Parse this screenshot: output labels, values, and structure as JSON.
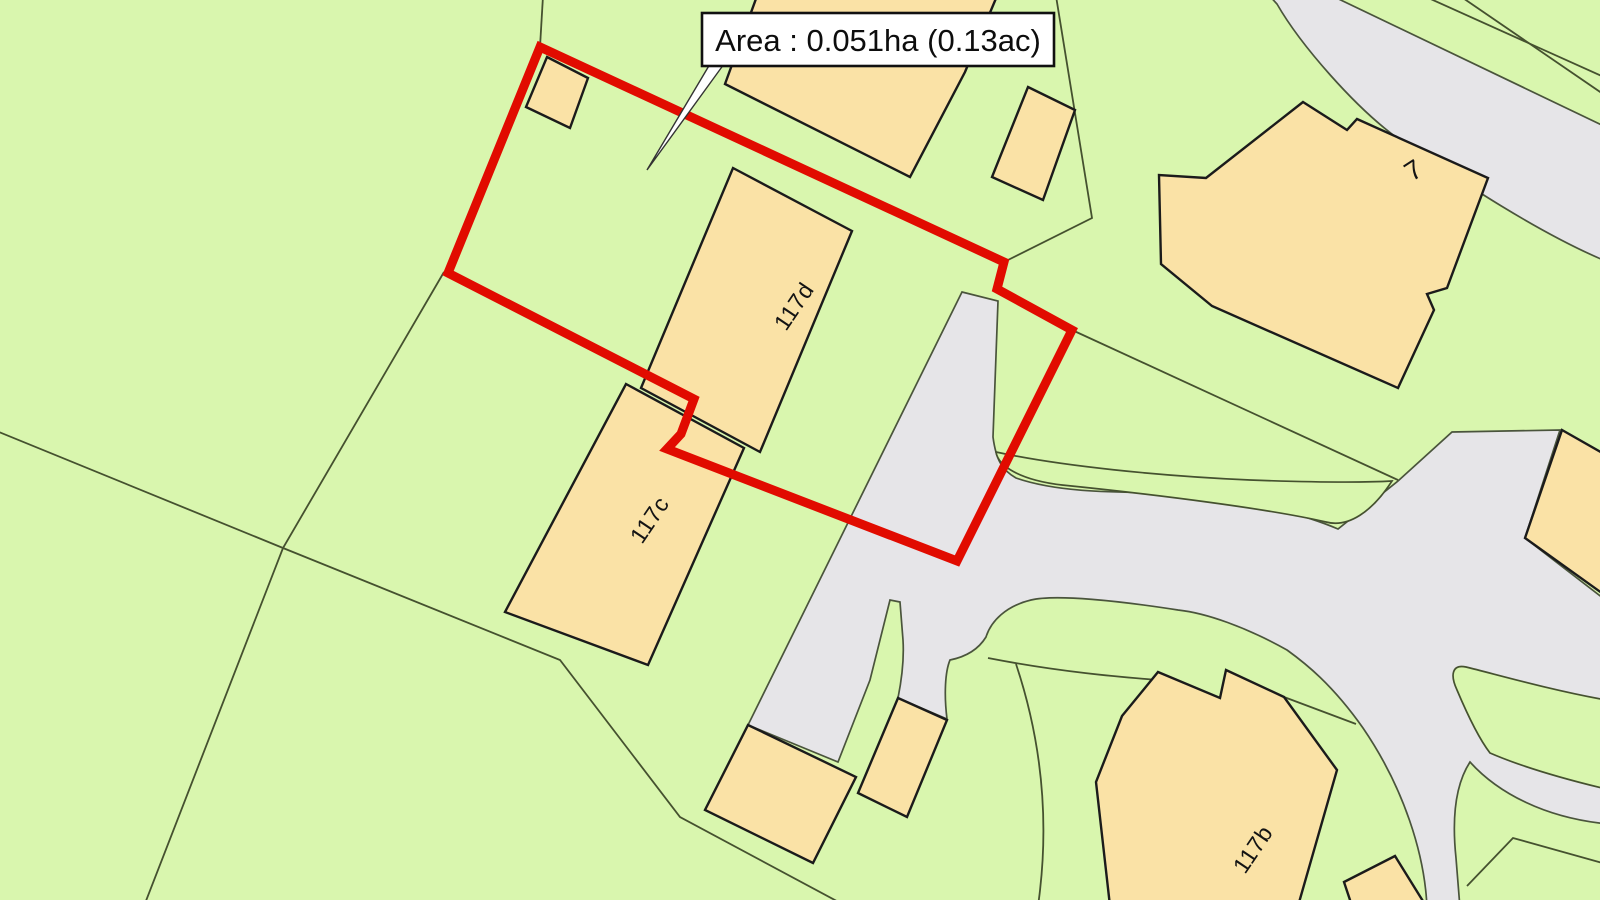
{
  "map": {
    "annotation": {
      "text": "Area : 0.051ha (0.13ac)"
    },
    "plots": {
      "d": "117d",
      "c": "117c",
      "b": "117b",
      "seven": "7"
    }
  },
  "colors": {
    "background": "#d9f6ae",
    "building": "#fae2a6",
    "road": "#e6e5e8",
    "boundary_red": "#e10b00",
    "annotation_bg": "#ffffff"
  }
}
